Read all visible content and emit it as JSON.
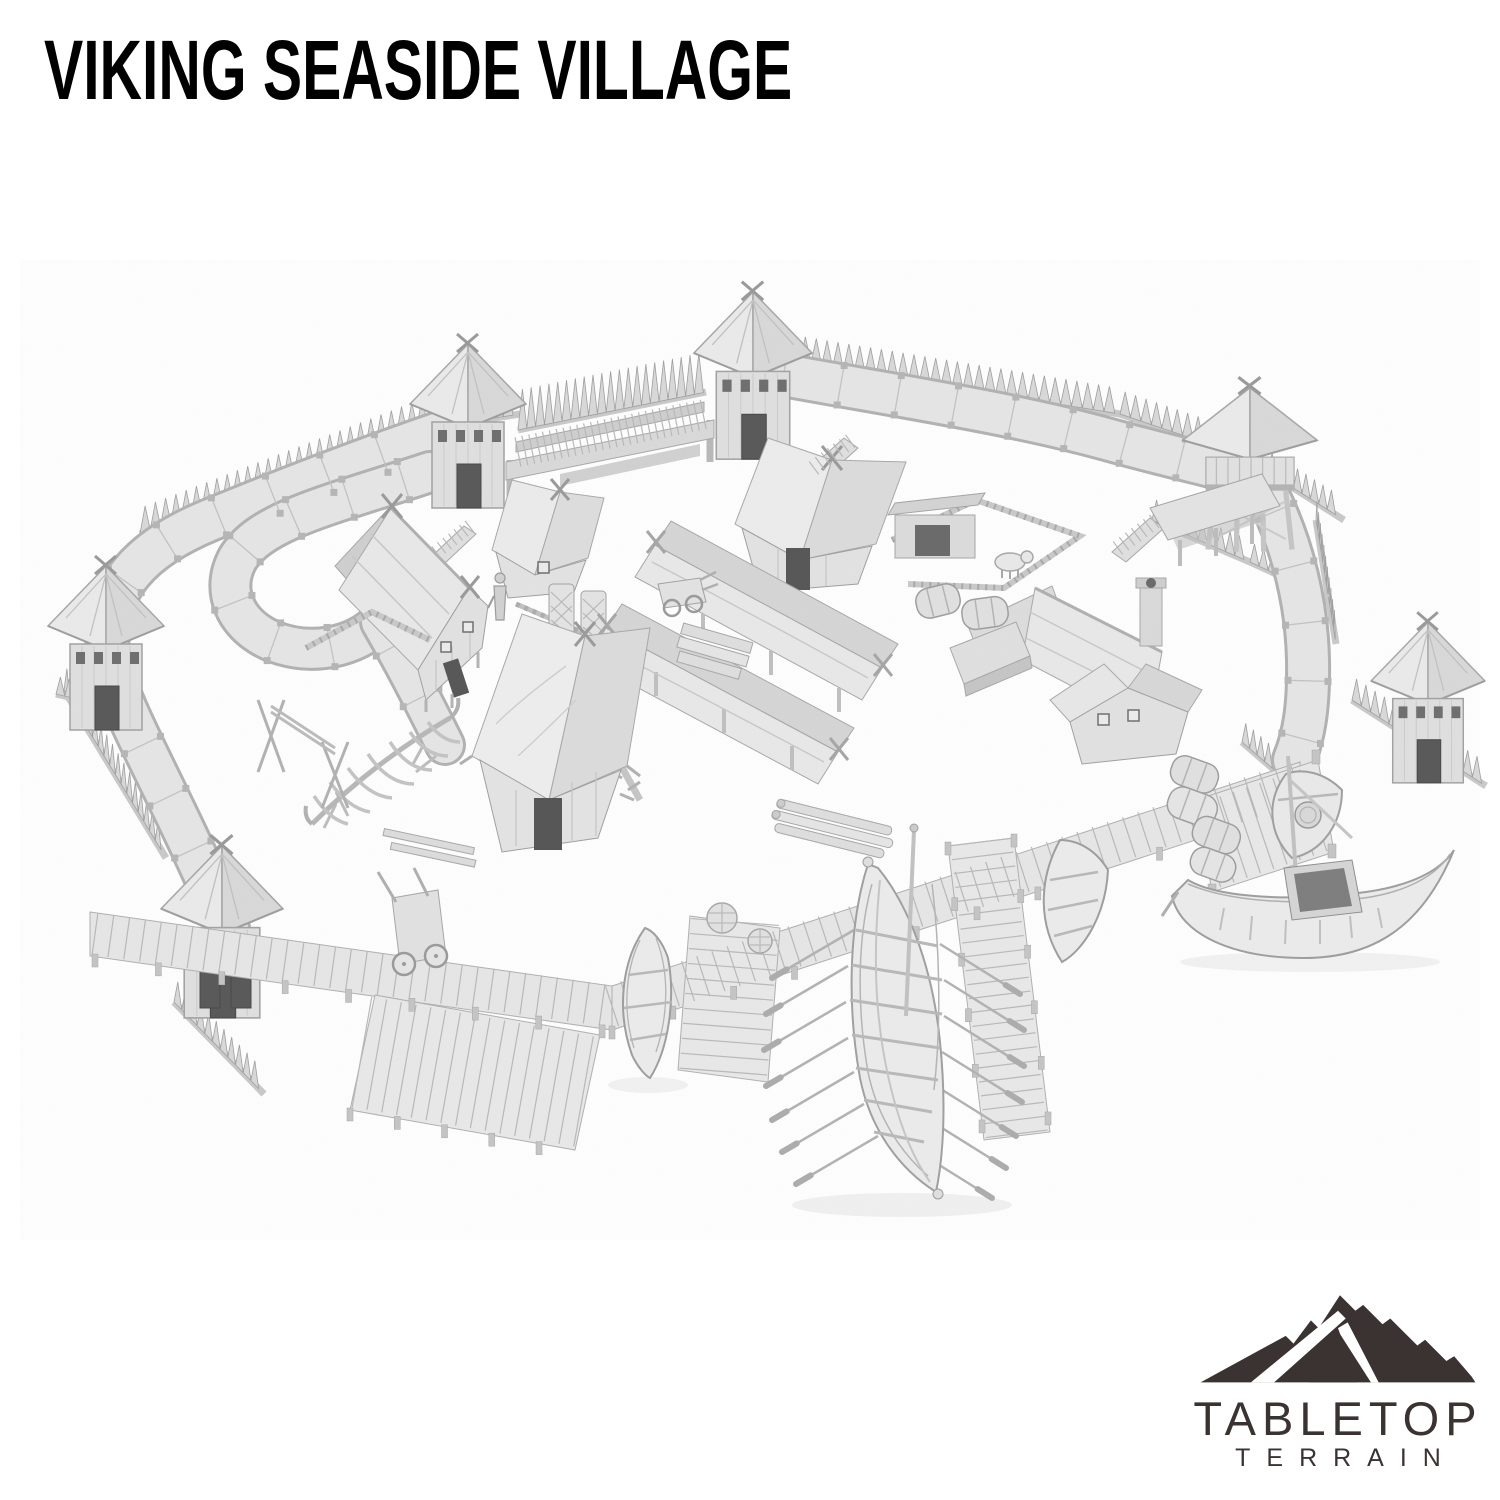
{
  "page": {
    "background_color": "#ffffff",
    "width_px": 1500,
    "height_px": 1500
  },
  "header": {
    "title": "VIKING SEASIDE VILLAGE",
    "title_color": "#000000"
  },
  "product_render": {
    "description": "Grayscale 3D render of a viking seaside village tabletop terrain set",
    "palette": {
      "model_light": "#e9e9e9",
      "model_mid": "#d9d9d9",
      "model_shadow": "#c2c2c2",
      "outline": "#a6a6a6",
      "opening_dark": "#585858"
    },
    "objects": [
      "spiked palisade walls",
      "earthen rampart walkway",
      "village gate with lintel",
      "six thatched watchtowers",
      "viking longhouses",
      "long thatched sheds",
      "pig pen with pig",
      "boat skeleton under construction",
      "drying rack",
      "barrels",
      "baskets",
      "hand carts",
      "log piles",
      "wooden dock and jetties",
      "viking longship with oars",
      "rowboats",
      "fishing boat with mast",
      "villager figure"
    ]
  },
  "brand": {
    "logo_icon": "mountain-logo-icon",
    "line1": "TABLETOP",
    "line2": "TERRAIN",
    "color": "#3a3331"
  }
}
